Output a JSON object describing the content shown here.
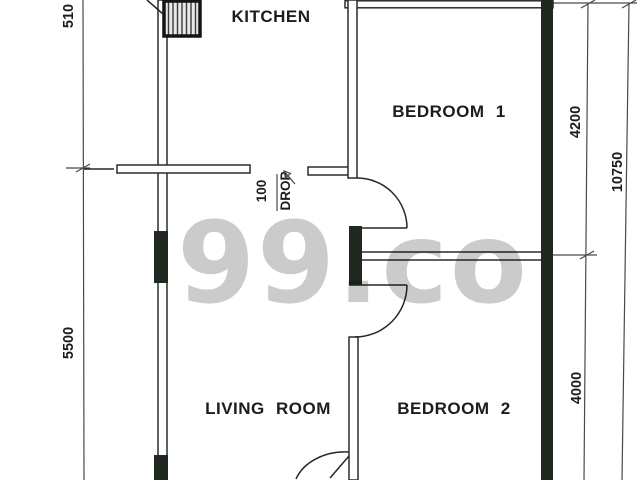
{
  "watermark": {
    "text": "99.co",
    "color": "#c8c8c8"
  },
  "rooms": {
    "kitchen": "KITCHEN",
    "bedroom1": "BEDROOM 1",
    "bedroom2": "BEDROOM 2",
    "living_room": "LIVING ROOM"
  },
  "dimensions": {
    "top_left": "510",
    "left_wall": "5500",
    "bedroom1_depth": "4200",
    "overall_depth": "10750",
    "bedroom2_depth": "4000"
  },
  "drop_note": {
    "value": "100",
    "word": "DROP"
  },
  "colors": {
    "wall_solid": "#20291f",
    "line": "#2b2b2b",
    "background": "#ffffff"
  }
}
